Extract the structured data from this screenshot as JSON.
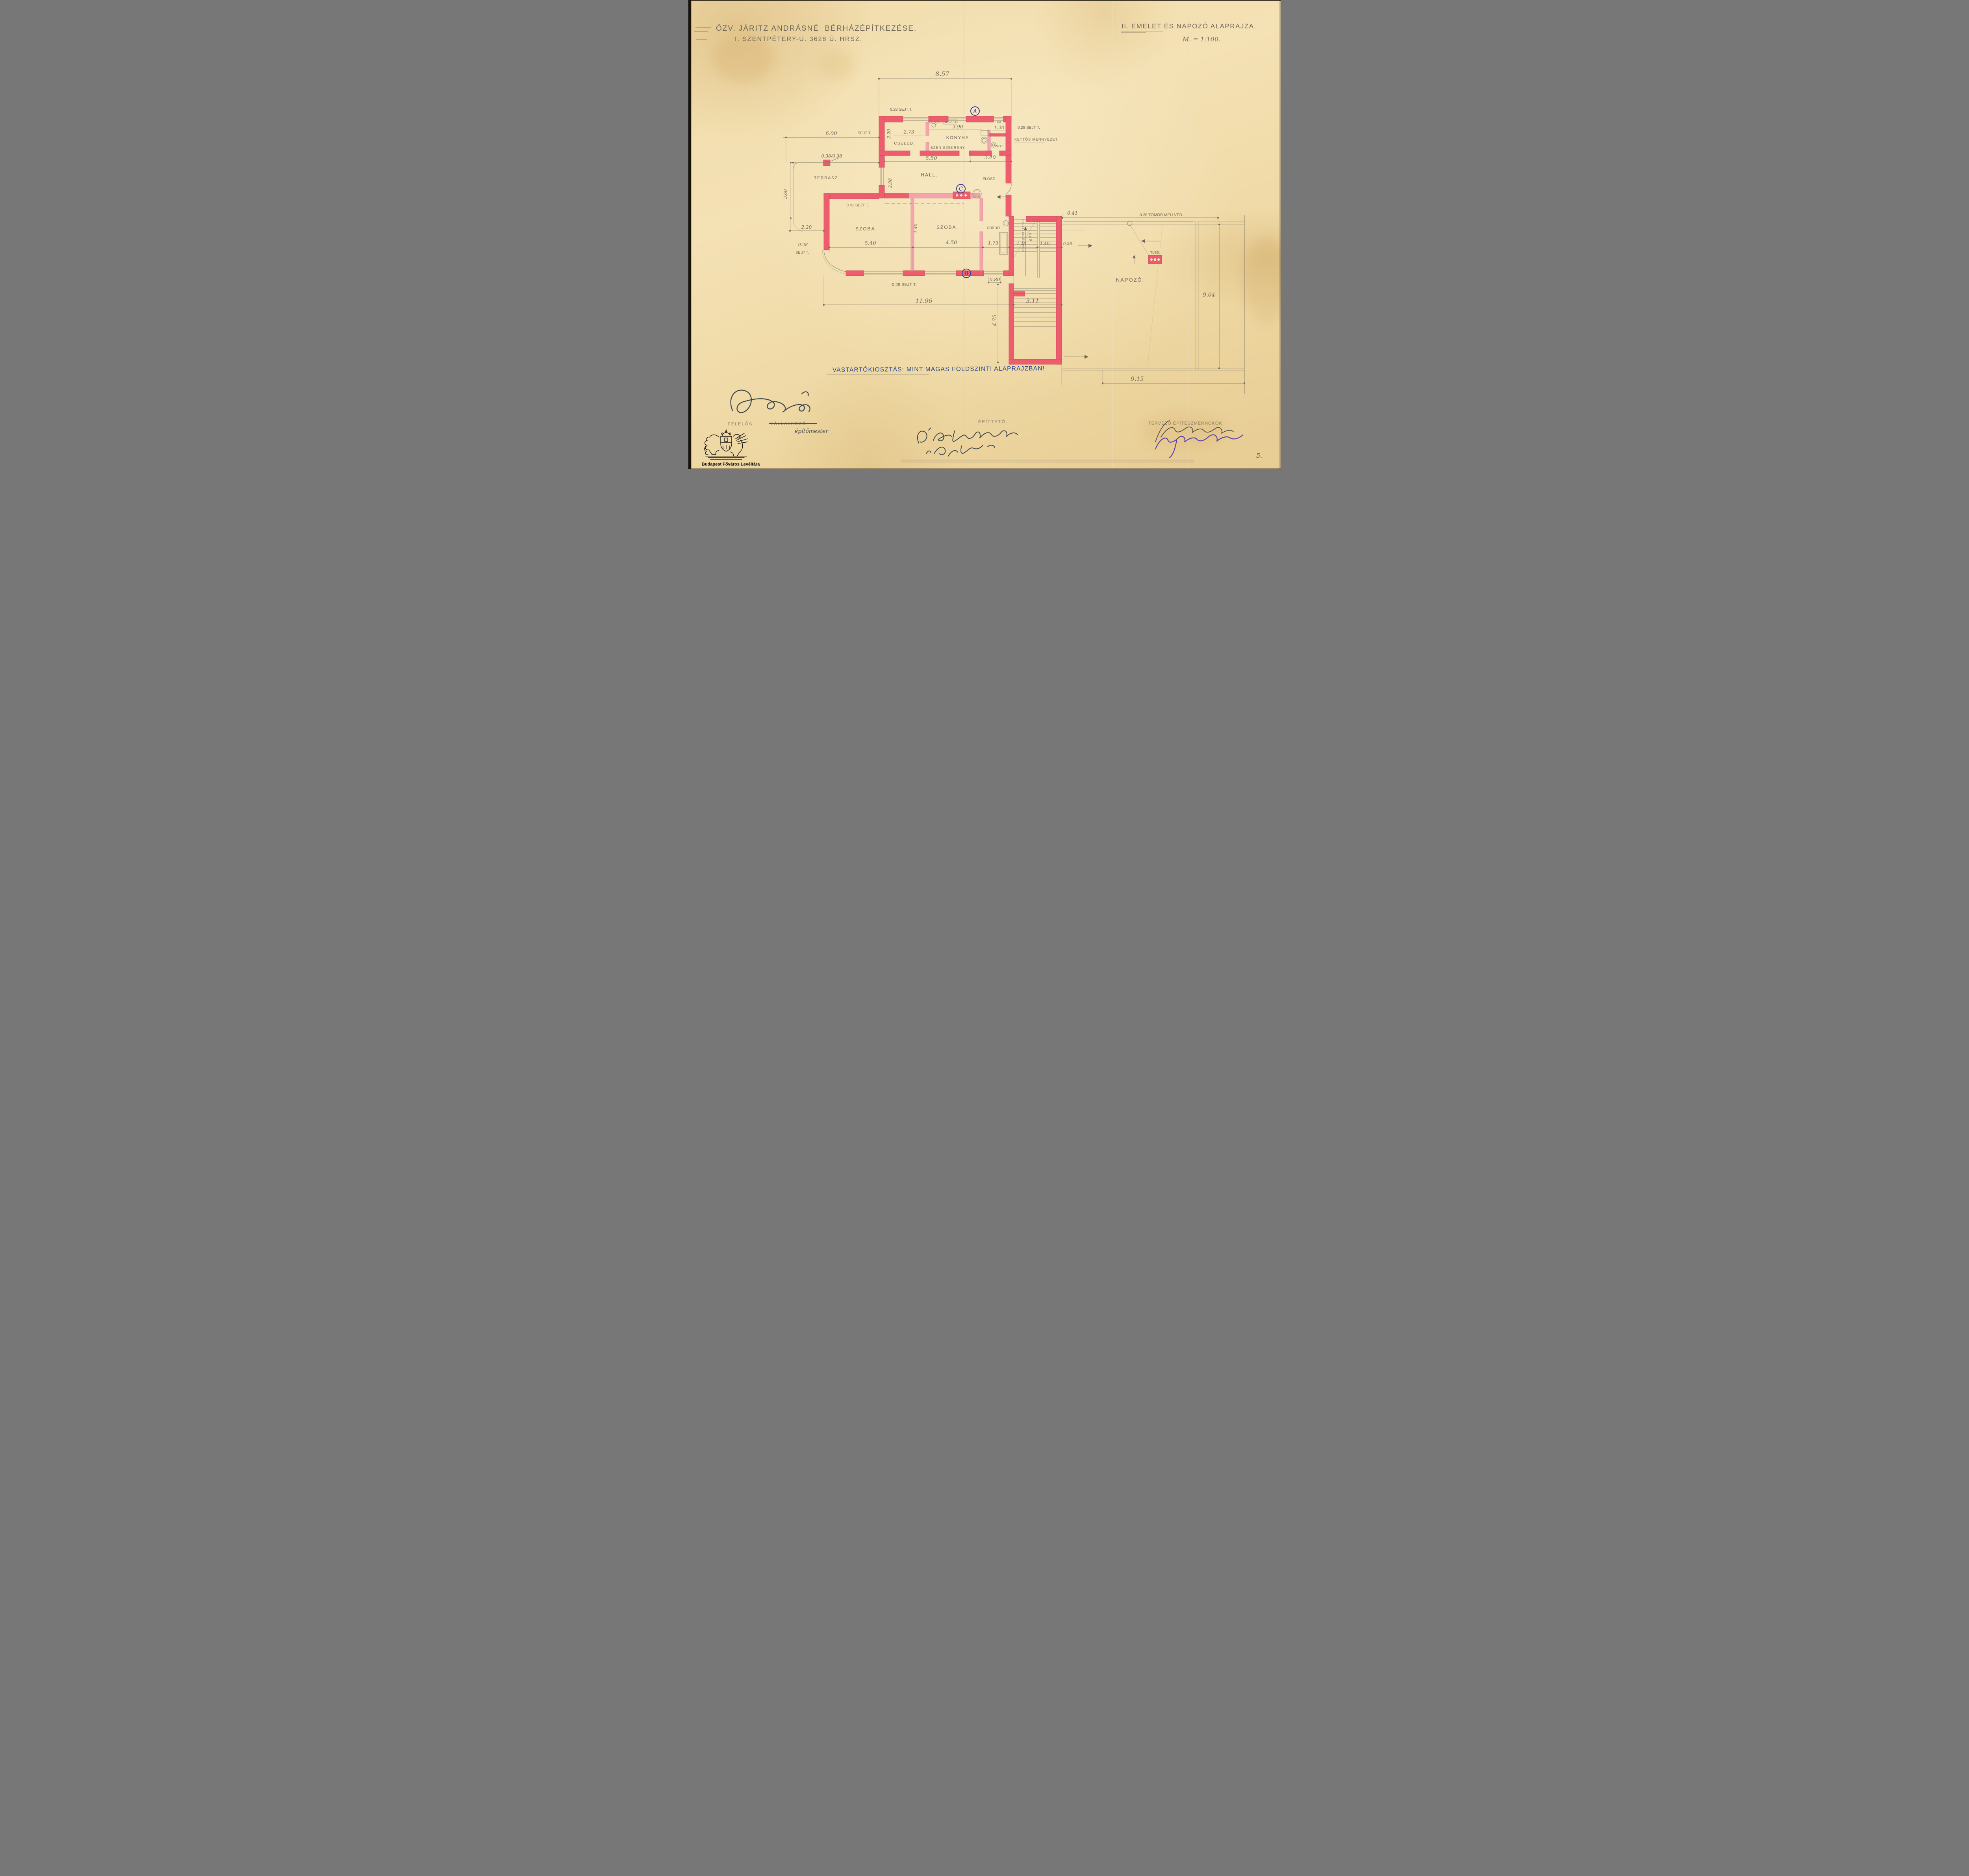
{
  "page": {
    "number": "5."
  },
  "archive": {
    "name": "Budapest Főváros Levéltára"
  },
  "title_block": {
    "owner_line": "ÖZV. JÁRITZ ANDRÁSNÉ  BÉRHÁZÉPÍTKEZÉSE.",
    "address_line": "I. SZENTPÉTERY-U. 3628 Ú. HRSZ."
  },
  "drawing_title": {
    "name": "II. EMELET ÉS NAPOZÓ ALAPRAJZA.",
    "scale": "M. = 1:100."
  },
  "note": "VASTARTÓKIOSZTÁS: MINT MAGAS FÖLDSZINTI ALAPRAJZBAN!",
  "rooms": {
    "konyha": "KONYHA",
    "cseled": "CSELÉD.",
    "hall": "HALL.",
    "elosz": "ELŐSZ.",
    "szoba_left": "SZOBA.",
    "szoba_right": "SZOBA.",
    "furdo": "FÜRDŐ.",
    "terrasz": "TERRASZ.",
    "napozo": "NAPOZÓ.",
    "wc": "W.C.",
    "kamra": "KA.",
    "asztal": "ASZTAL.",
    "szen_szekreny": "SZÉN SZEKRÉNY.",
    "tuss": "TUSS.",
    "lepcso": "GYÁMOLÍTOTT LÉPCSŐ"
  },
  "markers": {
    "a": "A",
    "b": "B",
    "c": "C"
  },
  "dims": {
    "top_width": "8.57",
    "sejt_top": "0.28 SEJT T.",
    "terrace_width": "6.00",
    "terrace_width_suffix": "SEJT T.",
    "pillar": "0.38/0.38",
    "kitchen_h": "2.20",
    "cseled_w": "2.73",
    "konyha_w": "3.90",
    "kamra_w": "1.20",
    "sejt_right": "0.28 SEJT T.",
    "kettos": "KETTŐS MENNYEZET.",
    "cseled_row_w": "5.50",
    "wc_row_w": "2.40",
    "hall_h": "2.98",
    "wing_sejt": "0.41 SEJT T.",
    "terrace_h": "3.60",
    "left_w": "2.20",
    "left_sejt_a": "0.28",
    "left_sejt_b": "SE JT T.",
    "szoba1_w": "5.40",
    "szoba2_w": "4.50",
    "furdo_w": "1.73",
    "stair_a": "1.10",
    "stair_b": "1.40",
    "stair_c": "0.28",
    "partition_d": "1.40",
    "bottom_sejt": "0.28 SEJT T.",
    "door_w": "0.80",
    "block_w": "11.96",
    "stair_w": "3.11",
    "stair_ext_h": "4.75",
    "parapet_a": "0.41",
    "parapet": "0.28 TÖMÖR MELLVÉD.",
    "deck_h": "9.04",
    "deck_w": "9.15",
    "stair_tread": "0.50"
  },
  "footer": {
    "felelos": "FELELŐS",
    "vallalkozo": "VÁLLALKOZÓ:",
    "epitomester": "építőmester",
    "epitteto": "ÉPÍTTETŐ:",
    "tervezo": "TERVEZŐ ÉPÍTÉSZMÉRNÖKÖK:",
    "sig_contractor": "Bereczkényi S. (aláírás)",
    "sig_owner1": "Ö. Jaritz Andrásné",
    "sig_owner2": "sz. Lejtay Ilona",
    "sig_architect1": "Medgyes Alajos (aláírás)",
    "sig_architect2": "Sebestyén Armánd (aláírás)"
  }
}
